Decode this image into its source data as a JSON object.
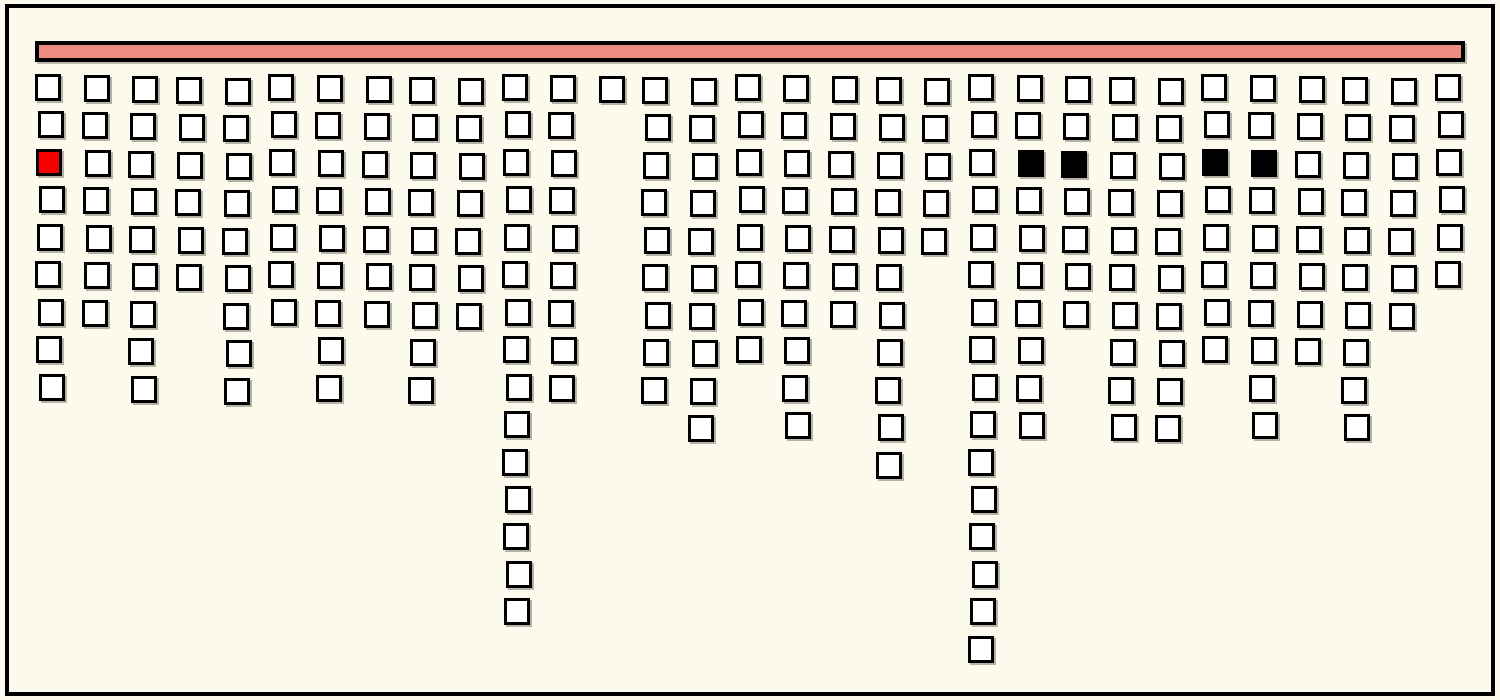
{
  "figure": {
    "background_color": "#FCFAEC",
    "frame_color": "#000000"
  },
  "top_bar": {
    "fill_color": "#EF8C82",
    "border_color": "#000000"
  },
  "squares": {
    "fill_color": "#FFFFFF",
    "border_color": "#000000",
    "red_color": "#F80000",
    "black_color": "#000000"
  },
  "chart_data": {
    "type": "bar",
    "subtype": "icicle-waffle-columns",
    "title": "",
    "xlabel": "",
    "ylabel": "",
    "description": "31 columns of outlined squares hang downward from a horizontal salmon bar; each column contains a count of stacked square cells; a few cells in the third row are highlighted.",
    "categories": [
      1,
      2,
      3,
      4,
      5,
      6,
      7,
      8,
      9,
      10,
      11,
      12,
      13,
      14,
      15,
      16,
      17,
      18,
      19,
      20,
      21,
      22,
      23,
      24,
      25,
      26,
      27,
      28,
      29,
      30,
      31
    ],
    "values": [
      9,
      7,
      9,
      6,
      9,
      7,
      9,
      7,
      9,
      7,
      15,
      9,
      1,
      9,
      10,
      8,
      10,
      7,
      11,
      5,
      16,
      10,
      7,
      10,
      10,
      8,
      10,
      8,
      10,
      7,
      6
    ],
    "ylim": [
      0,
      16
    ],
    "grid": false,
    "legend": "none",
    "highlight_cells": [
      {
        "col": 0,
        "row": 2,
        "color_name": "red"
      },
      {
        "col": 21,
        "row": 2,
        "color_name": "black"
      },
      {
        "col": 22,
        "row": 2,
        "color_name": "black"
      },
      {
        "col": 25,
        "row": 2,
        "color_name": "black"
      },
      {
        "col": 26,
        "row": 2,
        "color_name": "black"
      }
    ]
  }
}
